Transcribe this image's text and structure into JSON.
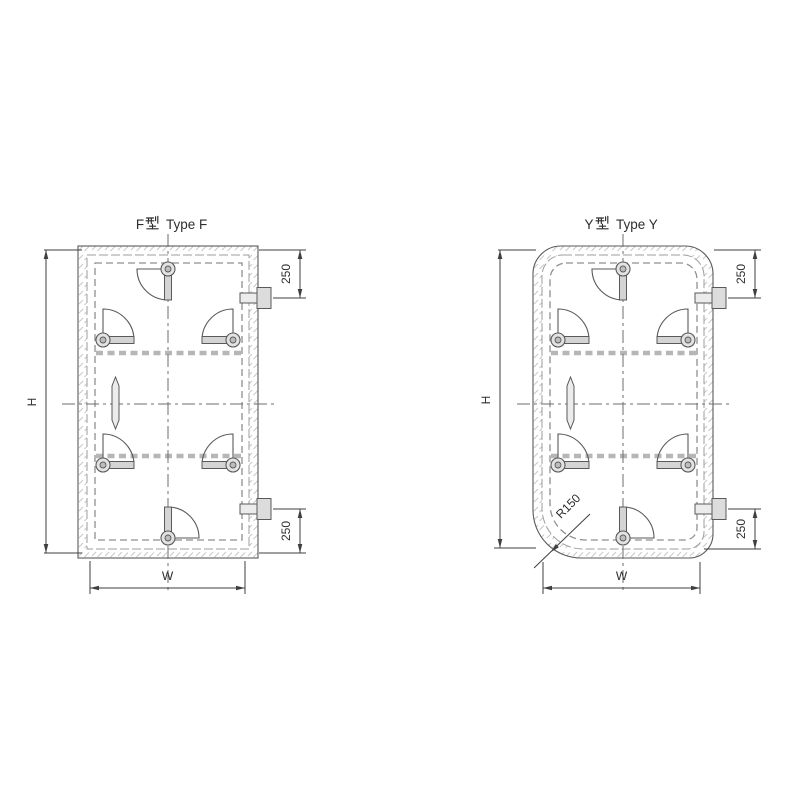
{
  "drawing": {
    "description": "Two weathertight door outline drawings",
    "doors": [
      {
        "id": "type-f",
        "name_cn": "F型",
        "name_cn_prefix": "F",
        "name_en": "Type F",
        "height_label": "H",
        "width_label": "W",
        "hinge_top_offset": "250",
        "hinge_bottom_offset": "250"
      },
      {
        "id": "type-y",
        "name_cn": "Y型",
        "name_cn_prefix": "Y",
        "name_en": "Type Y",
        "height_label": "H",
        "width_label": "W",
        "hinge_top_offset": "250",
        "hinge_bottom_offset": "250",
        "corner_radius": "R150"
      }
    ]
  },
  "colors": {
    "background": "#ffffff",
    "line": "#5a5a5a",
    "dimension": "#3f3f3f",
    "text": "#2d2d2d",
    "hatch": "#c9c9c9",
    "gasket_dash": "#b6b6b6"
  }
}
